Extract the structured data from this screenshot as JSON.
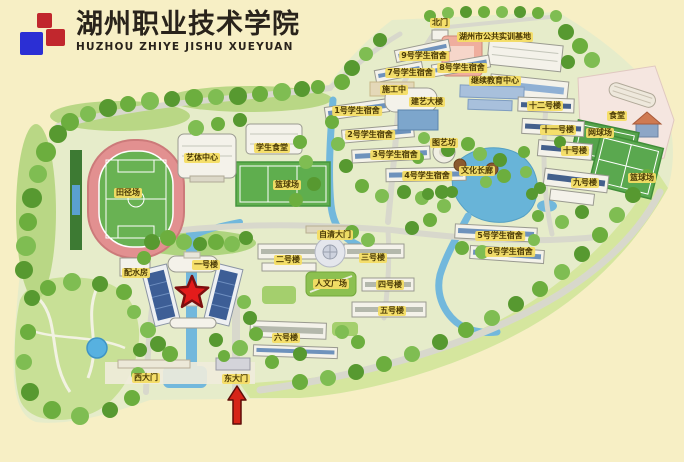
{
  "logo": {
    "title": "湖州职业技术学院",
    "subtitle": "HUZHOU ZHIYE JISHU XUEYUAN",
    "mark_colors": {
      "red": "#c1272d",
      "blue": "#2b2fd4"
    }
  },
  "map": {
    "background_color": "#f7efc5",
    "label_bg_color": "#f4dd64",
    "label_text_color": "#4a3a06",
    "markers": {
      "star": {
        "name": "location-star",
        "x": 192,
        "y": 293,
        "color": "#e31b1b"
      },
      "arrow": {
        "name": "entrance-arrow",
        "x": 237,
        "y": 405,
        "direction": "up",
        "color": "#d62418"
      }
    },
    "labels": [
      {
        "id": "north-gate",
        "text": "北门",
        "x": 440,
        "y": 23
      },
      {
        "id": "public-training-base",
        "text": "湖州市公共实训基地",
        "x": 495,
        "y": 37
      },
      {
        "id": "dorm-9",
        "text": "9号学生宿舍",
        "x": 424,
        "y": 56
      },
      {
        "id": "dorm-8",
        "text": "8号学生宿舍",
        "x": 462,
        "y": 68
      },
      {
        "id": "dorm-7",
        "text": "7号学生宿舍",
        "x": 410,
        "y": 73
      },
      {
        "id": "continuing-education-center",
        "text": "继续教育中心",
        "x": 495,
        "y": 81
      },
      {
        "id": "under-construction",
        "text": "施工中",
        "x": 394,
        "y": 90
      },
      {
        "id": "jianyi-building",
        "text": "建艺大楼",
        "x": 427,
        "y": 102
      },
      {
        "id": "building-12",
        "text": "十二号楼",
        "x": 545,
        "y": 106
      },
      {
        "id": "dorm-1",
        "text": "1号学生宿舍",
        "x": 357,
        "y": 111
      },
      {
        "id": "canteen-northeast",
        "text": "食堂",
        "x": 617,
        "y": 116
      },
      {
        "id": "building-11",
        "text": "十一号楼",
        "x": 558,
        "y": 130
      },
      {
        "id": "tennis-court",
        "text": "网球场",
        "x": 600,
        "y": 133
      },
      {
        "id": "dorm-2",
        "text": "2号学生宿舍",
        "x": 370,
        "y": 135
      },
      {
        "id": "tuyifang",
        "text": "图艺坊",
        "x": 444,
        "y": 143
      },
      {
        "id": "student-canteen",
        "text": "学生食堂",
        "x": 272,
        "y": 148
      },
      {
        "id": "building-10",
        "text": "十号楼",
        "x": 575,
        "y": 151
      },
      {
        "id": "dorm-3",
        "text": "3号学生宿舍",
        "x": 395,
        "y": 155
      },
      {
        "id": "arts-sports-center",
        "text": "艺体中心",
        "x": 202,
        "y": 158
      },
      {
        "id": "culture-corridor",
        "text": "文化长廊",
        "x": 477,
        "y": 171
      },
      {
        "id": "dorm-4",
        "text": "4号学生宿舍",
        "x": 427,
        "y": 176
      },
      {
        "id": "basketball-court-east",
        "text": "篮球场",
        "x": 642,
        "y": 178
      },
      {
        "id": "building-9",
        "text": "九号楼",
        "x": 585,
        "y": 183
      },
      {
        "id": "basketball-court-mid",
        "text": "篮球场",
        "x": 287,
        "y": 185
      },
      {
        "id": "athletic-field",
        "text": "田径场",
        "x": 128,
        "y": 193
      },
      {
        "id": "ziqing-gate",
        "text": "自清大门",
        "x": 335,
        "y": 235
      },
      {
        "id": "dorm-5",
        "text": "5号学生宿舍",
        "x": 500,
        "y": 236
      },
      {
        "id": "dorm-6",
        "text": "6号学生宿舍",
        "x": 510,
        "y": 252
      },
      {
        "id": "building-no2",
        "text": "二号楼",
        "x": 288,
        "y": 260
      },
      {
        "id": "building-no3",
        "text": "三号楼",
        "x": 373,
        "y": 258
      },
      {
        "id": "building-no1",
        "text": "一号楼",
        "x": 206,
        "y": 265
      },
      {
        "id": "water-supply-house",
        "text": "配水房",
        "x": 136,
        "y": 273
      },
      {
        "id": "humanities-plaza",
        "text": "人文广场",
        "x": 331,
        "y": 284
      },
      {
        "id": "building-no4",
        "text": "四号楼",
        "x": 390,
        "y": 285
      },
      {
        "id": "building-no5",
        "text": "五号楼",
        "x": 392,
        "y": 311
      },
      {
        "id": "building-no6",
        "text": "六号楼",
        "x": 286,
        "y": 338
      },
      {
        "id": "west-gate",
        "text": "西大门",
        "x": 146,
        "y": 378
      },
      {
        "id": "east-gate",
        "text": "东大门",
        "x": 236,
        "y": 379
      }
    ]
  }
}
